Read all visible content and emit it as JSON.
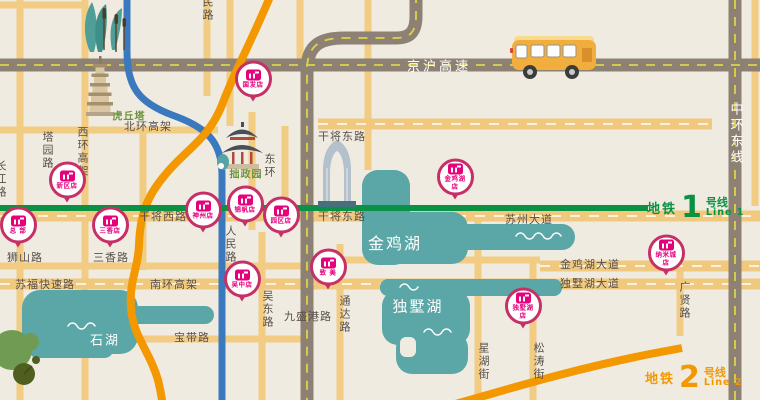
{
  "map": {
    "colors": {
      "background": "#f0ebe1",
      "highway_gray": "#8c8173",
      "road_yellow": "#f2cc82",
      "metro_line1_green": "#0a9144",
      "metro_line2_orange": "#f39800",
      "river_blue": "#3a79bd",
      "lake_teal": "#5ba6a6",
      "pin_crimson": "#c73066",
      "brand_magenta": "#e5007d",
      "label_dark": "#57504a",
      "landmark_green": "#6e9340"
    },
    "metro": {
      "line1": {
        "prefix": "地铁",
        "number": "1",
        "suffix": "号线",
        "en": "Line 1"
      },
      "line2": {
        "prefix": "地铁",
        "number": "2",
        "suffix": "号线",
        "en": "Line 2"
      }
    },
    "labels": [
      {
        "t": "京沪高速",
        "x": 439,
        "y": 65,
        "c": "hwy"
      },
      {
        "t": "中环东线",
        "x": 735,
        "y": 102,
        "c": "hwy v"
      },
      {
        "t": "北环高架",
        "x": 148,
        "y": 126,
        "c": "road"
      },
      {
        "t": "西环高架",
        "x": 82,
        "y": 126,
        "c": "road v"
      },
      {
        "t": "塔园路",
        "x": 47,
        "y": 131,
        "c": "road v"
      },
      {
        "t": "长江路",
        "x": 0,
        "y": 160,
        "c": "road v"
      },
      {
        "t": "人民路",
        "x": 207,
        "y": -17,
        "c": "road v"
      },
      {
        "t": "东环",
        "x": 269,
        "y": 153,
        "c": "road v"
      },
      {
        "t": "人民路",
        "x": 230,
        "y": 225,
        "c": "road v"
      },
      {
        "t": "吴东路",
        "x": 267,
        "y": 290,
        "c": "road v"
      },
      {
        "t": "通达路",
        "x": 344,
        "y": 295,
        "c": "road v"
      },
      {
        "t": "星湖街",
        "x": 483,
        "y": 342,
        "c": "road v"
      },
      {
        "t": "松涛街",
        "x": 538,
        "y": 342,
        "c": "road v"
      },
      {
        "t": "广贤路",
        "x": 684,
        "y": 281,
        "c": "road v"
      },
      {
        "t": "干将东路",
        "x": 342,
        "y": 136,
        "c": "road"
      },
      {
        "t": "干将西路",
        "x": 163,
        "y": 216,
        "c": "road"
      },
      {
        "t": "干将东路",
        "x": 342,
        "y": 216,
        "c": "road"
      },
      {
        "t": "苏州大道",
        "x": 529,
        "y": 219,
        "c": "road"
      },
      {
        "t": "狮山路",
        "x": 25,
        "y": 257,
        "c": "road"
      },
      {
        "t": "三香路",
        "x": 111,
        "y": 257,
        "c": "road"
      },
      {
        "t": "苏福快速路",
        "x": 45,
        "y": 284,
        "c": "road"
      },
      {
        "t": "南环高架",
        "x": 174,
        "y": 284,
        "c": "road"
      },
      {
        "t": "宝带路",
        "x": 192,
        "y": 337,
        "c": "road"
      },
      {
        "t": "九盛港路",
        "x": 308,
        "y": 316,
        "c": "road"
      },
      {
        "t": "金鸡湖大道",
        "x": 590,
        "y": 264,
        "c": "road"
      },
      {
        "t": "独墅湖大道",
        "x": 590,
        "y": 283,
        "c": "road"
      },
      {
        "t": "虎丘塔",
        "x": 129,
        "y": 115,
        "c": "lm"
      },
      {
        "t": "拙政园",
        "x": 246,
        "y": 173,
        "c": "lm"
      },
      {
        "t": "金鸡湖",
        "x": 395,
        "y": 242,
        "c": "lake",
        "s": 16
      },
      {
        "t": "独墅湖",
        "x": 418,
        "y": 306,
        "c": "lake",
        "s": 15
      },
      {
        "t": "石湖",
        "x": 105,
        "y": 339,
        "c": "lake",
        "s": 13
      }
    ],
    "pins": [
      {
        "lines": [
          "国发店"
        ],
        "x": 253,
        "y": 82
      },
      {
        "lines": [
          "新区店"
        ],
        "x": 67,
        "y": 183
      },
      {
        "lines": [
          "总 部"
        ],
        "x": 18,
        "y": 228
      },
      {
        "lines": [
          "三香店"
        ],
        "x": 110,
        "y": 228
      },
      {
        "lines": [
          "神州店"
        ],
        "x": 203,
        "y": 213
      },
      {
        "lines": [
          "锦帆店"
        ],
        "x": 245,
        "y": 207
      },
      {
        "lines": [
          "园区店"
        ],
        "x": 281,
        "y": 218
      },
      {
        "lines": [
          "吴中店"
        ],
        "x": 242,
        "y": 282
      },
      {
        "lines": [
          "致 美"
        ],
        "x": 328,
        "y": 270
      },
      {
        "lines": [
          "金鸡湖",
          "店"
        ],
        "x": 455,
        "y": 180
      },
      {
        "lines": [
          "纳米城",
          "店"
        ],
        "x": 666,
        "y": 256
      },
      {
        "lines": [
          "独墅湖",
          "店"
        ],
        "x": 523,
        "y": 309
      }
    ]
  }
}
